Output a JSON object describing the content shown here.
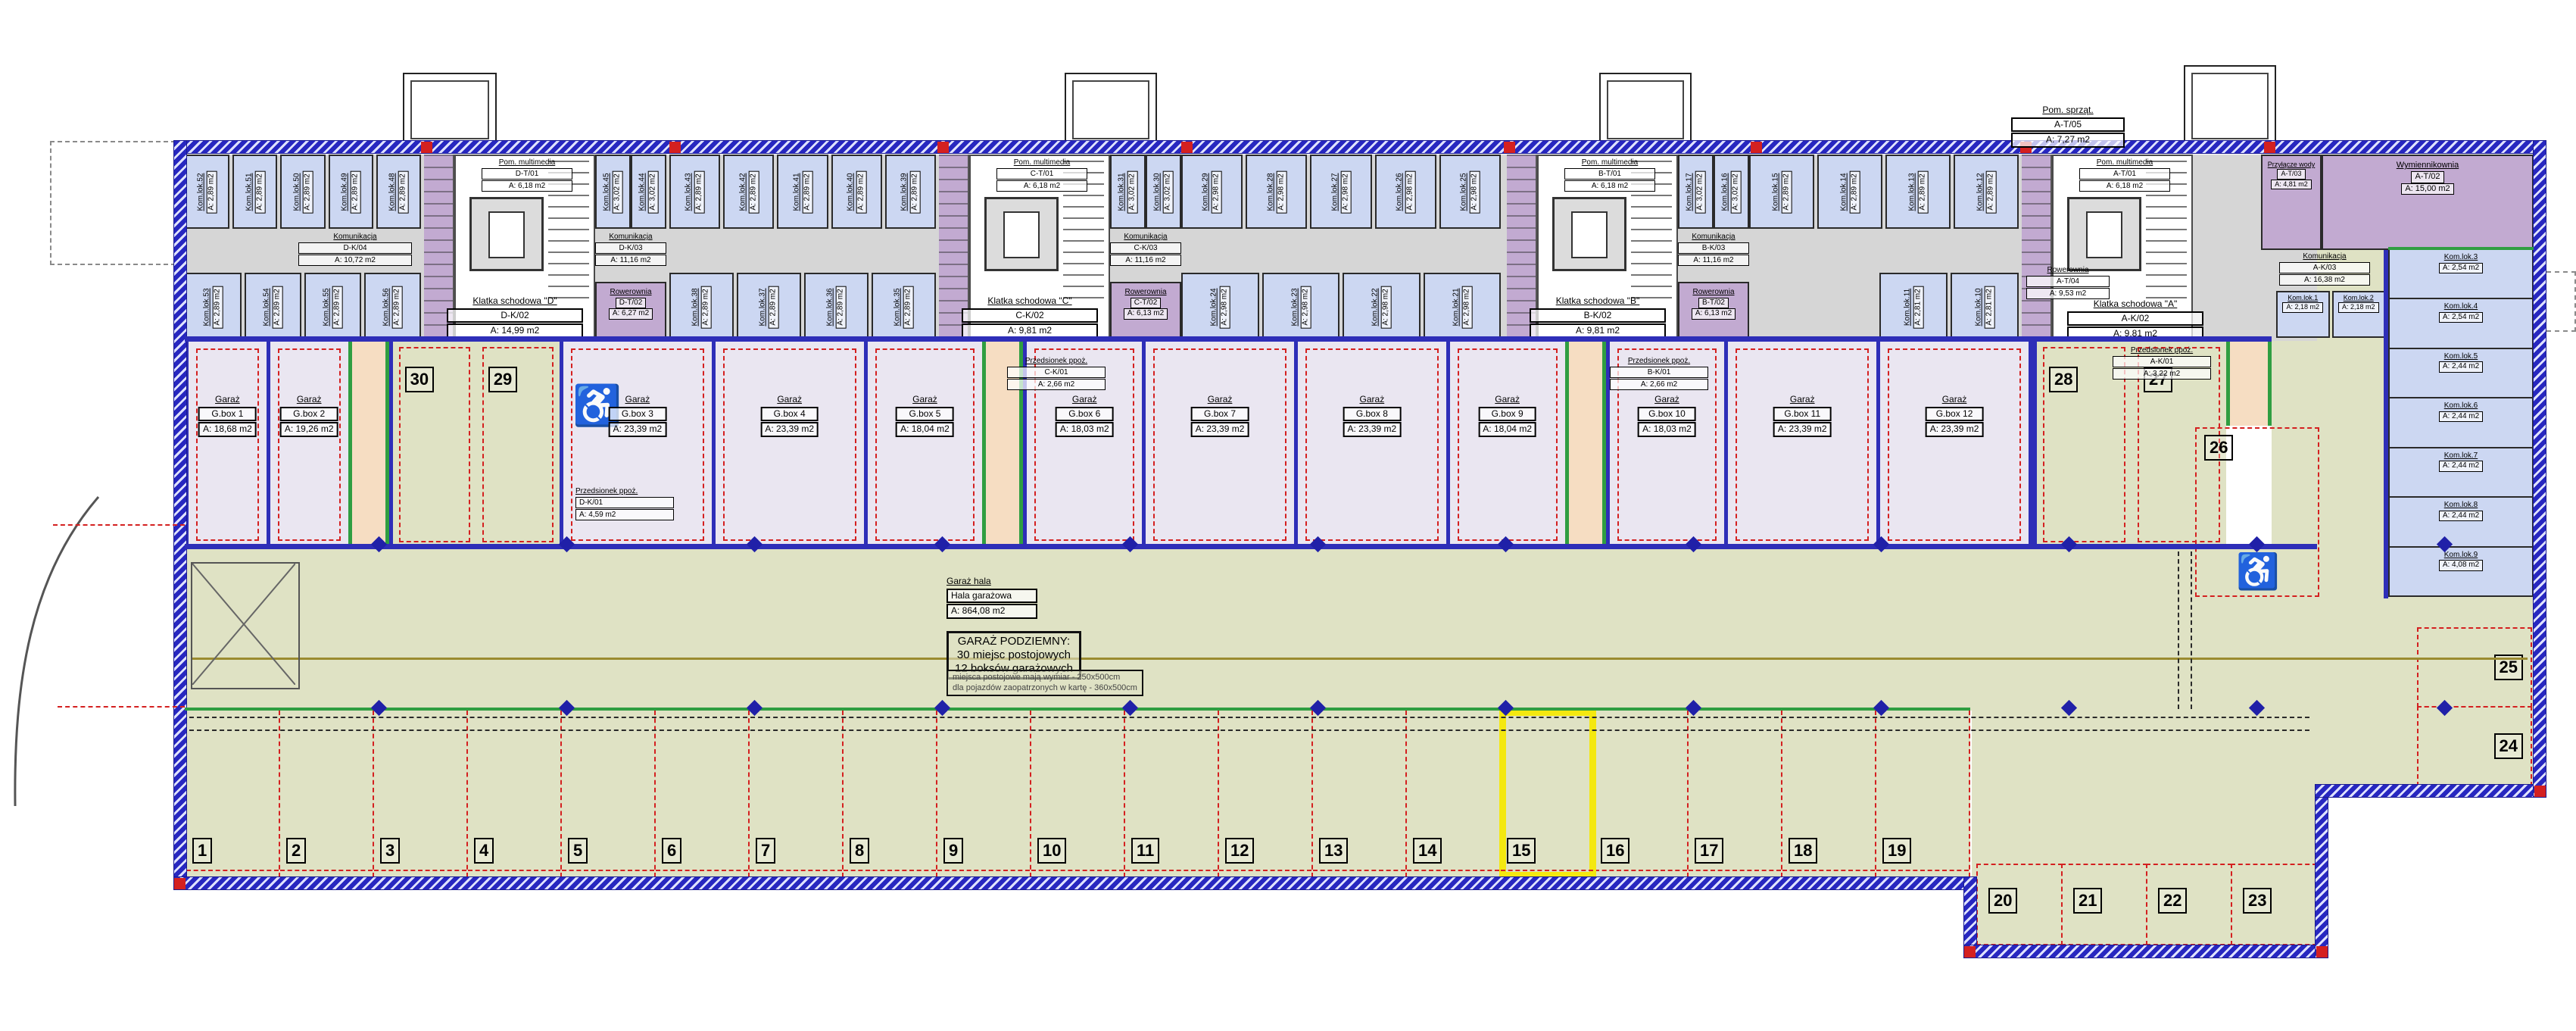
{
  "plan": {
    "hall_label": {
      "title": "Garaż hala",
      "name": "Hala garażowa",
      "area": "A: 864,08 m2"
    },
    "summary": {
      "title": "GARAŻ PODZIEMNY:",
      "line1": "30 miejsc postojowych",
      "line2": "12 boksów garażowych"
    },
    "notes": {
      "line1": "miejsca postojowe mają wymiar - 250x500cm",
      "line2": "dla pojazdów zaopatrzonych w kartę - 360x500cm"
    },
    "colors": {
      "hall": "#dfe2c4",
      "storage_cell": "#ccd7f2",
      "technical": "#c2aad1",
      "box": "#eae6f1",
      "wall": "#2727c0",
      "spot_line": "#d42020",
      "highlight": "#f4e810",
      "vestibule": "#f6ddc2"
    }
  },
  "garage_boxes": [
    {
      "label": "Garaż",
      "name": "G.box 1",
      "area": "A: 18,68 m2",
      "accessible": false
    },
    {
      "label": "Garaż",
      "name": "G.box 2",
      "area": "A: 19,26 m2",
      "accessible": false
    },
    {
      "label": "Garaż",
      "name": "G.box 3",
      "area": "A: 23,39 m2",
      "accessible": true
    },
    {
      "label": "Garaż",
      "name": "G.box 4",
      "area": "A: 23,39 m2",
      "accessible": false
    },
    {
      "label": "Garaż",
      "name": "G.box 5",
      "area": "A: 18,04 m2",
      "accessible": false
    },
    {
      "label": "Garaż",
      "name": "G.box 6",
      "area": "A: 18,03 m2",
      "accessible": false
    },
    {
      "label": "Garaż",
      "name": "G.box 7",
      "area": "A: 23,39 m2",
      "accessible": false
    },
    {
      "label": "Garaż",
      "name": "G.box 8",
      "area": "A: 23,39 m2",
      "accessible": false
    },
    {
      "label": "Garaż",
      "name": "G.box 9",
      "area": "A: 18,04 m2",
      "accessible": false
    },
    {
      "label": "Garaż",
      "name": "G.box 10",
      "area": "A: 18,03 m2",
      "accessible": false
    },
    {
      "label": "Garaż",
      "name": "G.box 11",
      "area": "A: 23,39 m2",
      "accessible": false
    },
    {
      "label": "Garaż",
      "name": "G.box 12",
      "area": "A: 23,39 m2",
      "accessible": false
    }
  ],
  "parking": {
    "highlighted": 15,
    "main": [
      1,
      2,
      3,
      4,
      5,
      6,
      7,
      8,
      9,
      10,
      11,
      12,
      13,
      14,
      15,
      16,
      17,
      18,
      19
    ],
    "ext": [
      20,
      21,
      22,
      23
    ],
    "right": [
      25,
      24
    ],
    "upper_left": [
      30,
      29
    ],
    "upper_right": [
      28,
      27
    ],
    "accessible_spot": 26
  },
  "stairwells": [
    {
      "letter": "D",
      "multimedia_name": "Pom. multimedia",
      "multimedia_code": "D-T/01",
      "multimedia_area": "A: 6,18 m2",
      "stair_name": "Klatka schodowa \"D\"",
      "stair_code": "D-K/02",
      "stair_area": "A: 14,99 m2",
      "corridor_name": "Komunikacja",
      "corridor_code": "D-K/03",
      "corridor_area": "A: 11,16 m2",
      "bike_name": "Rowerownia",
      "bike_code": "D-T/02",
      "bike_area": "A: 6,27 m2",
      "cells": [
        {
          "name": "Kom.lok.45",
          "area": "A: 3,02 m2"
        },
        {
          "name": "Kom.lok.44",
          "area": "A: 3,02 m2"
        }
      ]
    },
    {
      "letter": "C",
      "multimedia_name": "Pom. multimedia",
      "multimedia_code": "C-T/01",
      "multimedia_area": "A: 6,18 m2",
      "stair_name": "Klatka schodowa \"C\"",
      "stair_code": "C-K/02",
      "stair_area": "A: 9,81 m2",
      "corridor_name": "Komunikacja",
      "corridor_code": "C-K/03",
      "corridor_area": "A: 11,16 m2",
      "bike_name": "Rowerownia",
      "bike_code": "C-T/02",
      "bike_area": "A: 6,13 m2",
      "cells": [
        {
          "name": "Kom.lok.31",
          "area": "A: 3,02 m2"
        },
        {
          "name": "Kom.lok.30",
          "area": "A: 3,02 m2"
        }
      ]
    },
    {
      "letter": "B",
      "multimedia_name": "Pom. multimedia",
      "multimedia_code": "B-T/01",
      "multimedia_area": "A: 6,18 m2",
      "stair_name": "Klatka schodowa \"B\"",
      "stair_code": "B-K/02",
      "stair_area": "A: 9,81 m2",
      "corridor_name": "Komunikacja",
      "corridor_code": "B-K/03",
      "corridor_area": "A: 11,16 m2",
      "bike_name": "Rowerownia",
      "bike_code": "B-T/02",
      "bike_area": "A: 6,13 m2",
      "cells": [
        {
          "name": "Kom.lok.17",
          "area": "A: 3,02 m2"
        },
        {
          "name": "Kom.lok.16",
          "area": "A: 3,02 m2"
        }
      ]
    }
  ],
  "stair_a": {
    "multimedia_name": "Pom. multimedia",
    "multimedia_code": "A-T/01",
    "multimedia_area": "A: 6,18 m2",
    "stair_name": "Klatka schodowa \"A\"",
    "stair_code": "A-K/02",
    "stair_area": "A: 9,81 m2",
    "corridor_name": "Komunikacja",
    "corridor_code": "A-K/03",
    "corridor_area": "A: 16,38 m2",
    "bike_name": "Rowerownia",
    "bike_code": "A-T/04",
    "bike_area": "A: 9,53 m2"
  },
  "tech_rooms": {
    "water": {
      "name": "Przyłącze wody",
      "code": "A-T/03",
      "area": "A: 4,81 m2"
    },
    "heat": {
      "name": "Wymiennikownia",
      "code": "A-T/02",
      "area": "A: 15,00 m2"
    },
    "cleaning": {
      "name": "Pom. sprząt.",
      "code": "A-T/05",
      "area": "A: 7,27 m2"
    }
  },
  "vestibules": {
    "d": {
      "name": "Przedsionek ppoż.",
      "code": "D-K/01",
      "area": "A: 4,59 m2"
    },
    "c": {
      "name": "Przedsionek ppoż.",
      "code": "C-K/01",
      "area": "A: 2,66 m2"
    },
    "b": {
      "name": "Przedsionek ppoż.",
      "code": "B-K/01",
      "area": "A: 2,66 m2"
    },
    "a": {
      "name": "Przedsionek ppoż.",
      "code": "A-K/01",
      "area": "A: 3,22 m2"
    }
  },
  "corridors": {
    "seg1": {
      "name": "Komunikacja",
      "code": "D-K/04",
      "area": "A: 10,72 m2"
    }
  },
  "cells": {
    "seg1_top": [
      {
        "name": "Kom.lok.52",
        "area": "A: 2,89 m2"
      },
      {
        "name": "Kom.lok.51",
        "area": "A: 2,89 m2"
      },
      {
        "name": "Kom.lok.50",
        "area": "A: 2,89 m2"
      },
      {
        "name": "Kom.lok.49",
        "area": "A: 2,89 m2"
      },
      {
        "name": "Kom.lok.48",
        "area": "A: 2,89 m2"
      }
    ],
    "seg1_bottom": [
      {
        "name": "Kom.lok.53",
        "area": "A: 2,89 m2"
      },
      {
        "name": "Kom.lok.54",
        "area": "A: 2,89 m2"
      },
      {
        "name": "Kom.lok.55",
        "area": "A: 2,89 m2"
      },
      {
        "name": "Kom.lok.56",
        "area": "A: 2,89 m2"
      }
    ],
    "seg2_top": [
      {
        "name": "Kom.lok.43",
        "area": "A: 2,89 m2"
      },
      {
        "name": "Kom.lok.42",
        "area": "A: 2,89 m2"
      },
      {
        "name": "Kom.lok.41",
        "area": "A: 2,89 m2"
      },
      {
        "name": "Kom.lok.40",
        "area": "A: 2,89 m2"
      },
      {
        "name": "Kom.lok.39",
        "area": "A: 2,89 m2"
      }
    ],
    "seg2_bottom": [
      {
        "name": "Kom.lok.38",
        "area": "A: 2,89 m2"
      },
      {
        "name": "Kom.lok.37",
        "area": "A: 2,89 m2"
      },
      {
        "name": "Kom.lok.36",
        "area": "A: 2,89 m2"
      },
      {
        "name": "Kom.lok.35",
        "area": "A: 2,89 m2"
      }
    ],
    "seg3_top": [
      {
        "name": "Kom.lok.29",
        "area": "A: 2,98 m2"
      },
      {
        "name": "Kom.lok.28",
        "area": "A: 2,98 m2"
      },
      {
        "name": "Kom.lok.27",
        "area": "A: 2,98 m2"
      },
      {
        "name": "Kom.lok.26",
        "area": "A: 2,98 m2"
      },
      {
        "name": "Kom.lok.25",
        "area": "A: 2,98 m2"
      }
    ],
    "seg3_bottom": [
      {
        "name": "Kom.lok.24",
        "area": "A: 2,98 m2"
      },
      {
        "name": "Kom.lok.23",
        "area": "A: 2,98 m2"
      },
      {
        "name": "Kom.lok.22",
        "area": "A: 2,98 m2"
      },
      {
        "name": "Kom.lok.21",
        "area": "A: 2,98 m2"
      }
    ],
    "seg4_top": [
      {
        "name": "Kom.lok.15",
        "area": "A: 2,89 m2"
      },
      {
        "name": "Kom.lok.14",
        "area": "A: 2,89 m2"
      },
      {
        "name": "Kom.lok.13",
        "area": "A: 2,89 m2"
      },
      {
        "name": "Kom.lok.12",
        "area": "A: 2,89 m2"
      }
    ],
    "seg4_bottom": [
      {
        "name": "Kom.lok.11",
        "area": "A: 2,81 m2"
      },
      {
        "name": "Kom.lok.10",
        "area": "A: 2,81 m2"
      }
    ],
    "corridor_a": [
      {
        "name": "Kom.lok.1",
        "area": "A: 2,18 m2"
      },
      {
        "name": "Kom.lok.2",
        "area": "A: 2,18 m2"
      }
    ],
    "right_col": [
      {
        "name": "Kom.lok.3",
        "area": "A: 2,54 m2"
      },
      {
        "name": "Kom.lok.4",
        "area": "A: 2,54 m2"
      },
      {
        "name": "Kom.lok.5",
        "area": "A: 2,44 m2"
      },
      {
        "name": "Kom.lok.6",
        "area": "A: 2,44 m2"
      },
      {
        "name": "Kom.lok.7",
        "area": "A: 2,44 m2"
      },
      {
        "name": "Kom.lok.8",
        "area": "A: 2,44 m2"
      },
      {
        "name": "Kom.lok.9",
        "area": "A: 4,08 m2"
      }
    ]
  }
}
